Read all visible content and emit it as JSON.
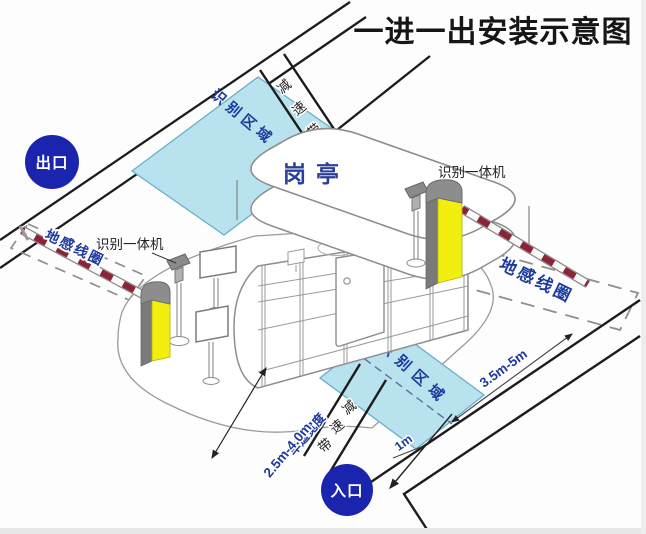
{
  "title": "一进一出安装示意图",
  "badges": {
    "exit": "出口",
    "entrance": "入口"
  },
  "booth": {
    "label": "岗亭"
  },
  "zones": {
    "upper_recognition": "识别区域",
    "lower_recognition": "识别区域"
  },
  "loops": {
    "left": "地感线圈",
    "right": "地感线圈"
  },
  "cameras": {
    "left": "识别一体机",
    "right": "识别一体机"
  },
  "speed_bumps": {
    "top": [
      "减",
      "速",
      "带"
    ],
    "bottom": [
      "减",
      "速",
      "带"
    ]
  },
  "dimensions": {
    "lane_width_label": "车道宽度",
    "lane_width_value": "2.5m-4.0m",
    "loop_length": "3.5m-5m",
    "loop_offset": "1m"
  },
  "colors": {
    "badge_blue": "#1b24ad",
    "zone_fill": "#b8e2ee",
    "zone_stroke": "#69aec8",
    "label_navy": "#1d3a9e",
    "barrier_yellow": "#f1ee10",
    "arm_red": "#8d2336"
  }
}
